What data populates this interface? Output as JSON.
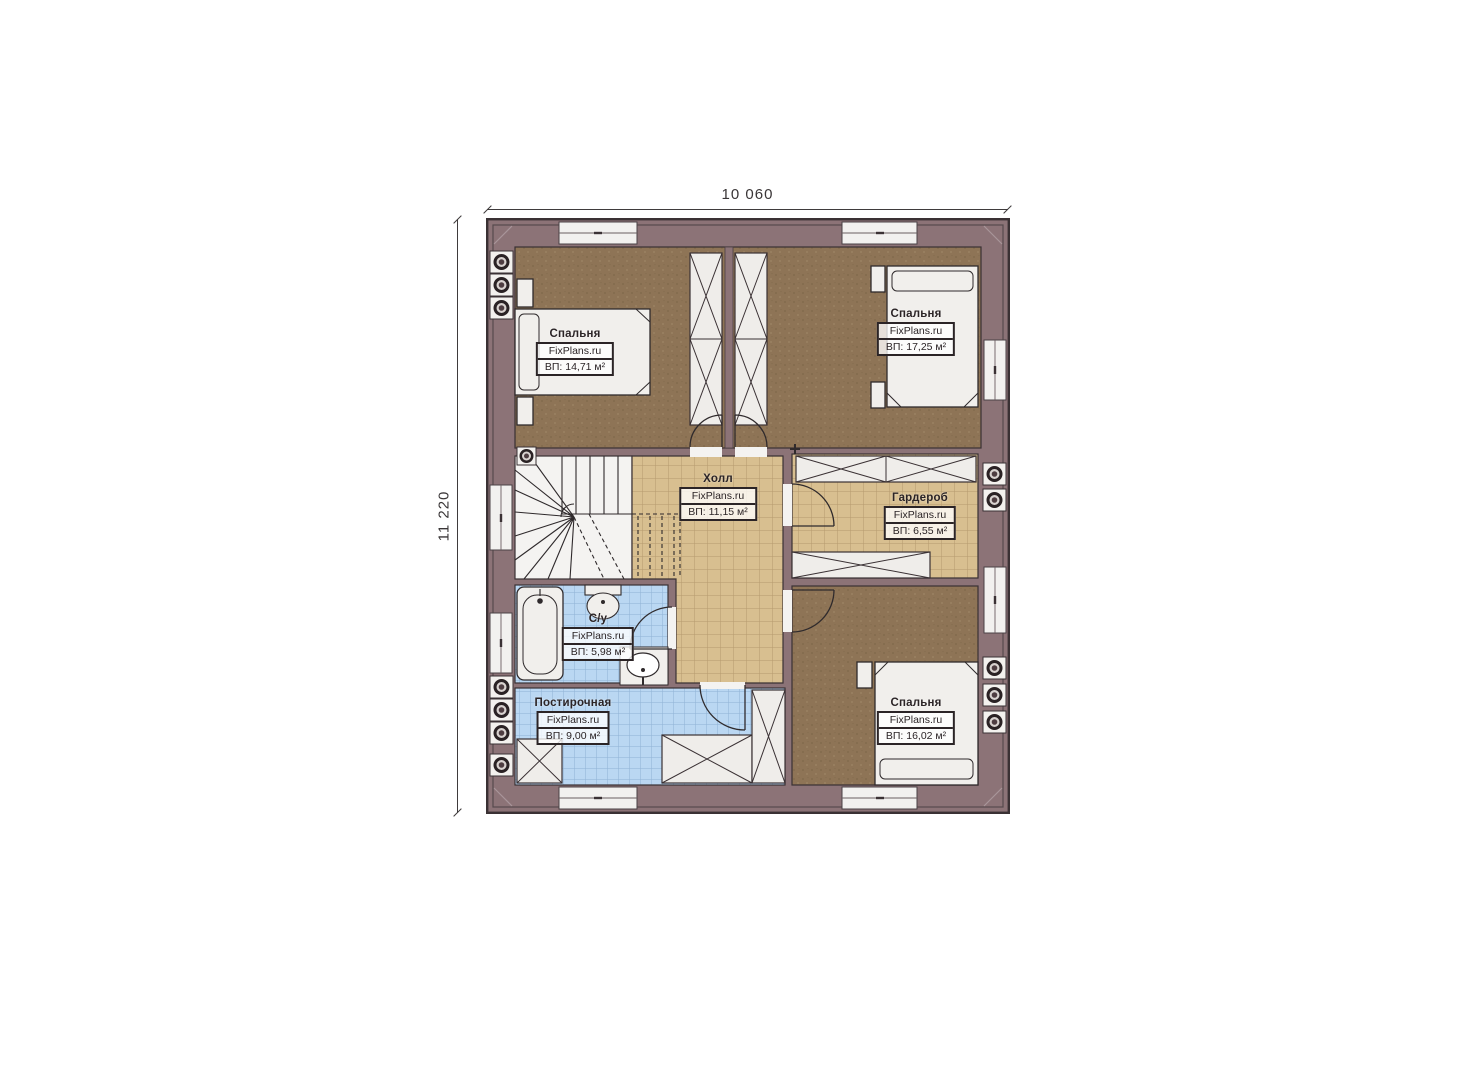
{
  "page": {
    "background": "#ffffff",
    "type": "floor-plan"
  },
  "dimensions": {
    "width_label": "10 060",
    "height_label": "11 220"
  },
  "branding": {
    "watermark": "FixPlans.ru"
  },
  "rooms": [
    {
      "id": "bedroom-top-left",
      "name": "Спальня",
      "brand": "FixPlans.ru",
      "area": "ВП: 14,71 м²"
    },
    {
      "id": "bedroom-top-right",
      "name": "Спальня",
      "brand": "FixPlans.ru",
      "area": "ВП: 17,25 м²"
    },
    {
      "id": "hall",
      "name": "Холл",
      "brand": "FixPlans.ru",
      "area": "ВП: 11,15 м²"
    },
    {
      "id": "wardrobe",
      "name": "Гардероб",
      "brand": "FixPlans.ru",
      "area": "ВП: 6,55 м²"
    },
    {
      "id": "bathroom",
      "name": "С/у",
      "brand": "FixPlans.ru",
      "area": "ВП: 5,98 м²"
    },
    {
      "id": "laundry",
      "name": "Постирочная",
      "brand": "FixPlans.ru",
      "area": "ВП: 9,00 м²"
    },
    {
      "id": "bedroom-bottom-right",
      "name": "Спальня",
      "brand": "FixPlans.ru",
      "area": "ВП: 16,02 м²"
    }
  ],
  "colors": {
    "wall": "#8c7377",
    "outline": "#3a3134",
    "carpet": "#8e7456",
    "tan_tile": "#d8bf90",
    "blue_tile": "#bad7f2",
    "fixture": "#f1efec"
  }
}
